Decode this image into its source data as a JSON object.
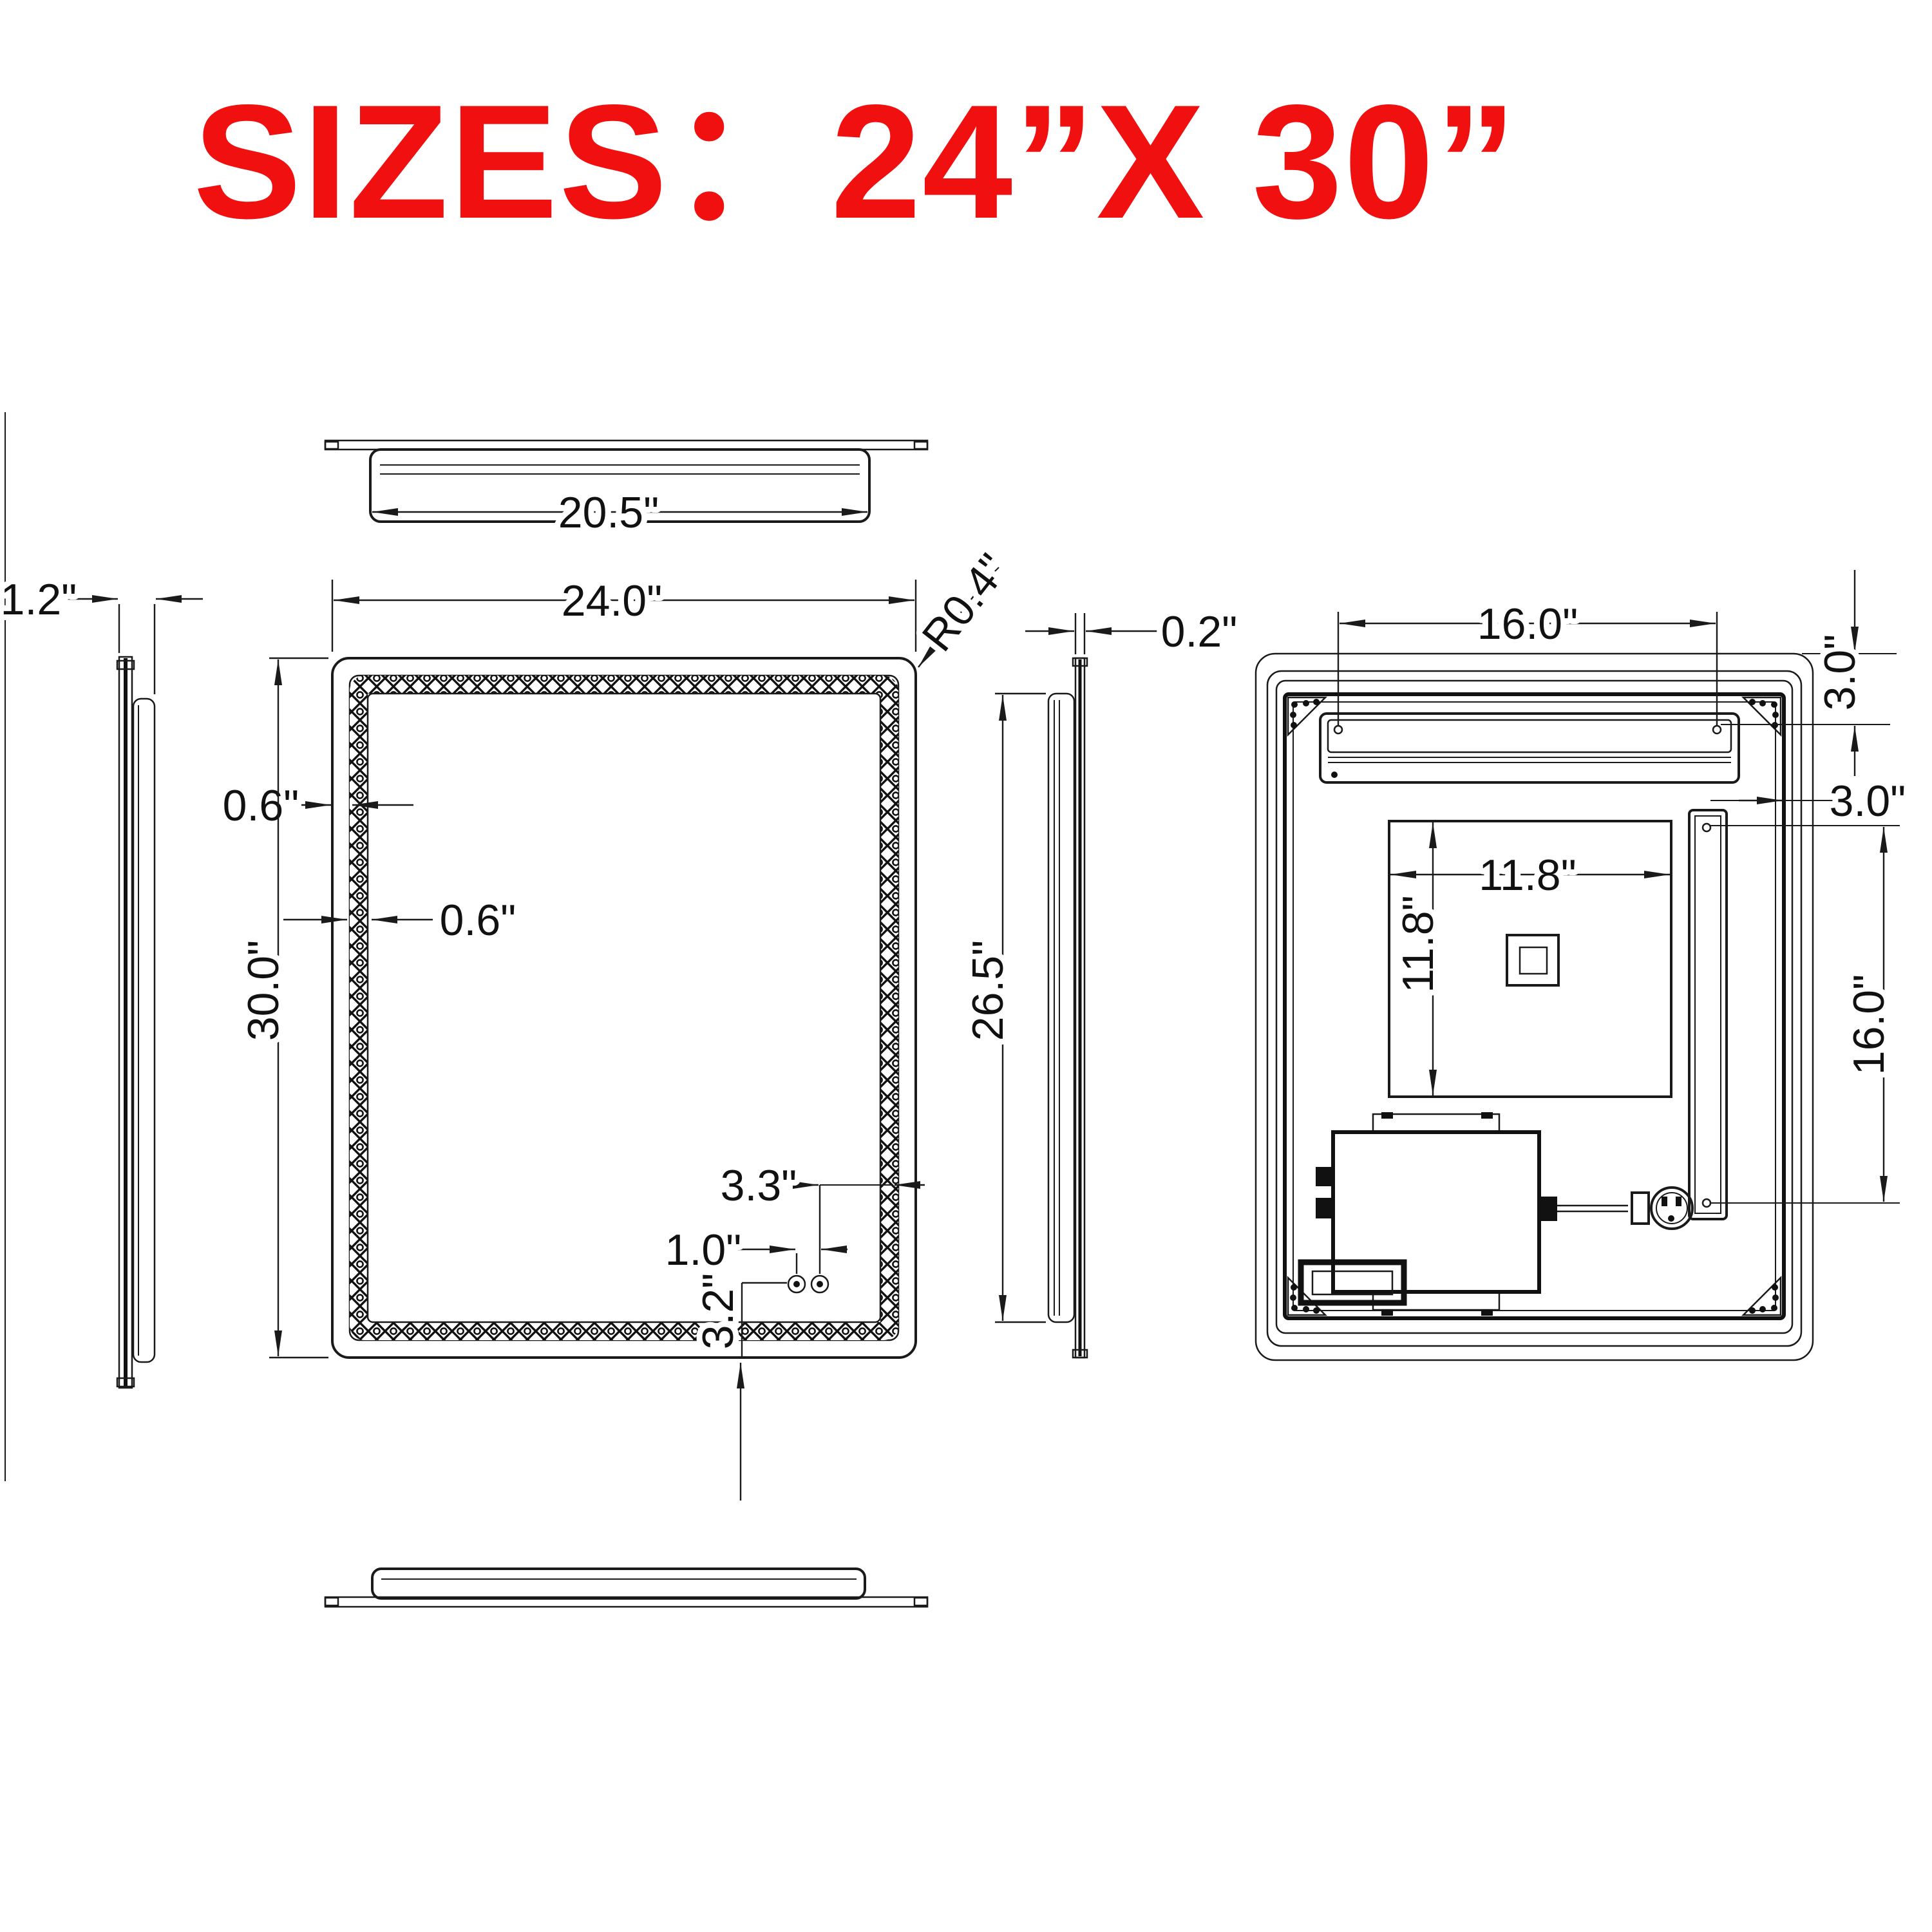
{
  "title": {
    "label": "SIZES：",
    "value": "24”X 30”",
    "color": "#f01010"
  },
  "dims": {
    "top_width": "20.5\"",
    "side_depth": "1.2\"",
    "front_width": "24.0\"",
    "corner_radius": "R0.4\"",
    "edge_to_led_gap": "0.6\"",
    "led_band_width": "0.6\"",
    "front_height": "30.0\"",
    "button_offset_right": "3.3\"",
    "button_spacing": "1.0\"",
    "button_offset_bottom": "3.2\"",
    "glass_thickness": "0.2\"",
    "side_frame_height": "26.5\"",
    "hanger_span": "16.0\"",
    "hanger_top_offset": "3.0\"",
    "hanger_side_offset": "3.0\"",
    "hanger_height": "16.0\"",
    "backbox_width": "11.8\"",
    "backbox_height": "11.8\""
  }
}
